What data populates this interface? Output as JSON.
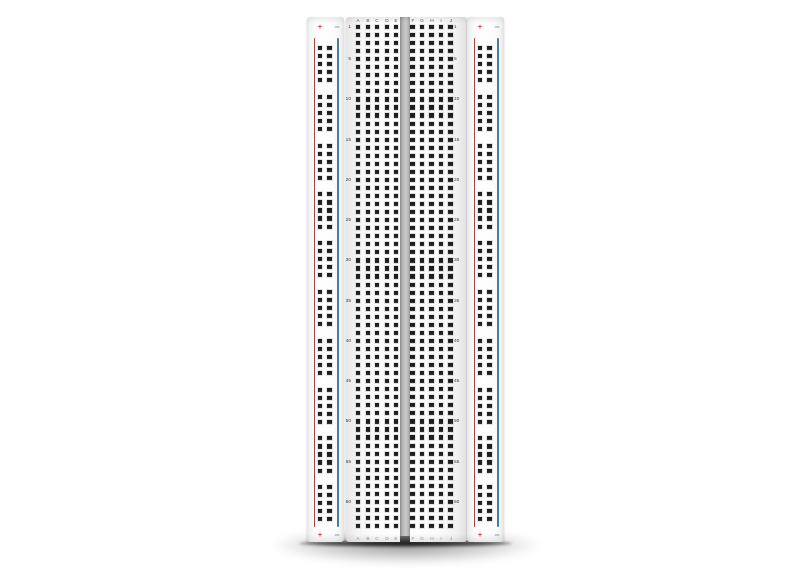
{
  "image": {
    "background": "#ffffff",
    "subject": "solderless breadboard, vertical front view with drop shadow"
  },
  "board": {
    "rows": 63,
    "row_numbers": [
      1,
      5,
      10,
      15,
      20,
      25,
      30,
      35,
      40,
      45,
      50,
      55,
      60
    ],
    "left_columns": [
      "A",
      "B",
      "C",
      "D",
      "E"
    ],
    "right_columns": [
      "F",
      "G",
      "H",
      "I",
      "J"
    ],
    "power_rail": {
      "plus_sign": "+",
      "minus_sign": "−",
      "groups": 10,
      "holes_per_group": 5,
      "columns": 2
    },
    "colors": {
      "positive_line": "#a0473f",
      "negative_line": "#4a7ba1",
      "positive_sign": "#c23b33",
      "negative_sign": "#74a3c6",
      "hole": "#1d1d1d",
      "body": "#fbfbfb",
      "channel": "#b5b5b5",
      "row_number": "#3c3c3c",
      "column_letter_top": "#4f4f4f",
      "column_letter_bottom": "#8c8c8c"
    }
  }
}
